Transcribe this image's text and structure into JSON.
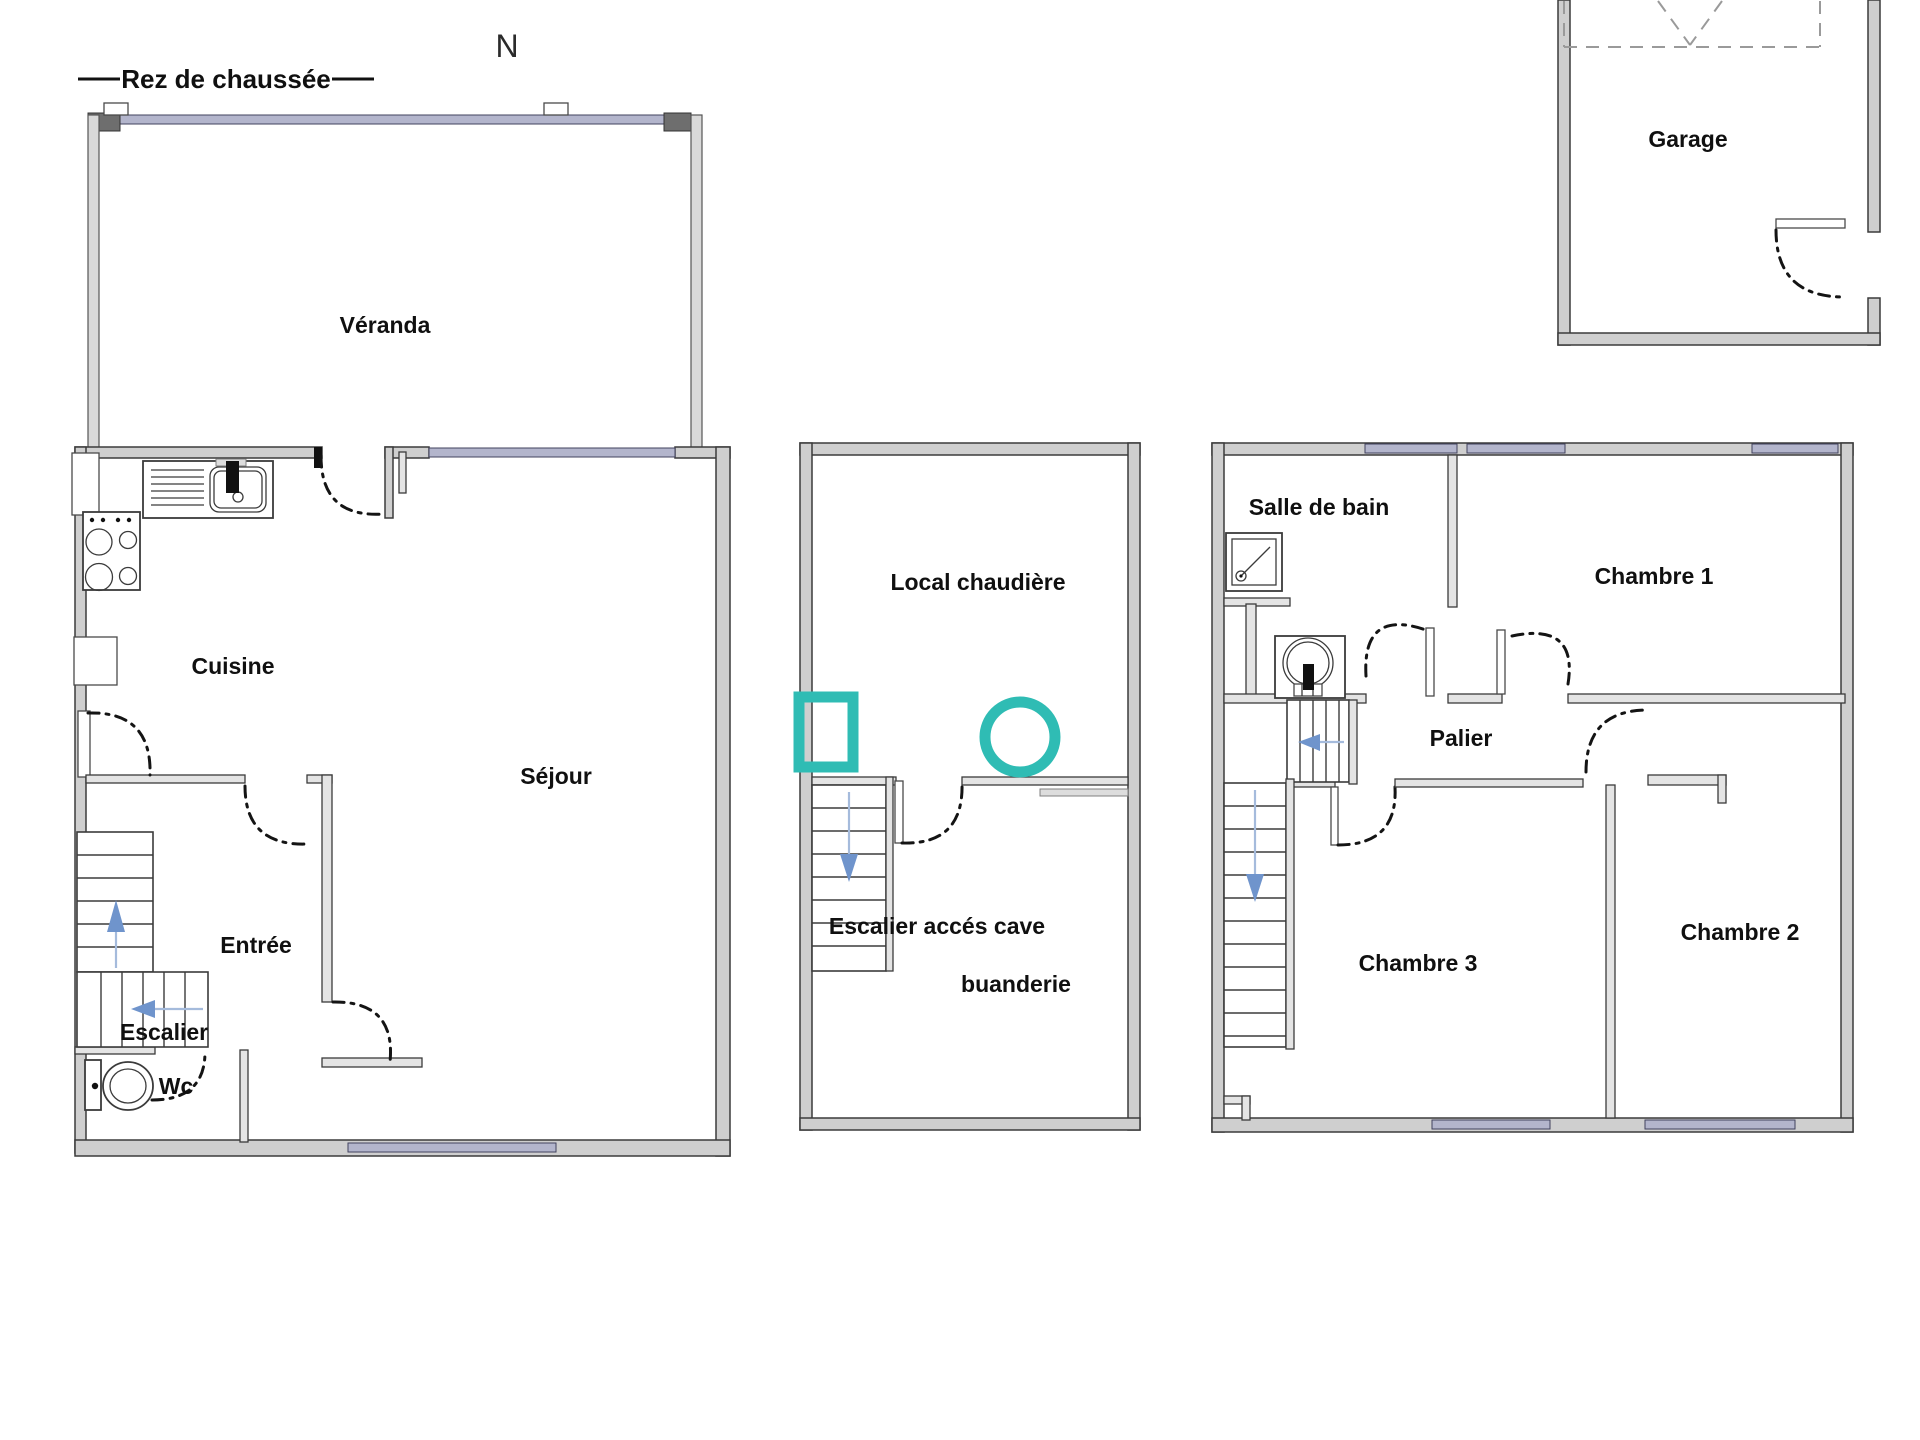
{
  "header": {
    "floor_title": "Rez de chaussée",
    "north_label": "N"
  },
  "colors": {
    "background": "#ffffff",
    "wall_fill": "#cfcfcf",
    "wall_stroke": "#3b3b3b",
    "window_glazing": "#b3b5cc",
    "accent_teal": "#2fbcb4",
    "stair_arrow_blue": "#6f94cc",
    "stair_guide_blue": "#a5bbdc",
    "door_swing": "#141414",
    "garage_dash": "#9a9a9a",
    "text": "#101010"
  },
  "plans": {
    "ground_floor": {
      "rooms": {
        "veranda": "Véranda",
        "cuisine": "Cuisine",
        "sejour": "Séjour",
        "entree": "Entrée",
        "escalier": "Escalier",
        "wc": "Wc"
      }
    },
    "basement_annex": {
      "rooms": {
        "local_chaudiere": "Local chaudière",
        "escalier_acces_cave": "Escalier accés cave",
        "buanderie": "buanderie"
      }
    },
    "first_floor": {
      "rooms": {
        "salle_de_bain": "Salle de bain",
        "chambre1": "Chambre 1",
        "palier": "Palier",
        "chambre3": "Chambre 3",
        "chambre2": "Chambre 2"
      }
    },
    "garage_block": {
      "rooms": {
        "garage": "Garage"
      }
    }
  },
  "icons": {
    "list": [
      "north-indicator",
      "kitchen-sink-icon",
      "stove-icon",
      "toilet-icon",
      "shower-icon",
      "washbasin-icon",
      "boiler-icon",
      "flue-vent-icon",
      "stair-arrow-up-icon",
      "stair-arrow-left-icon",
      "stair-arrow-down-icon",
      "door-swing-arc"
    ]
  }
}
